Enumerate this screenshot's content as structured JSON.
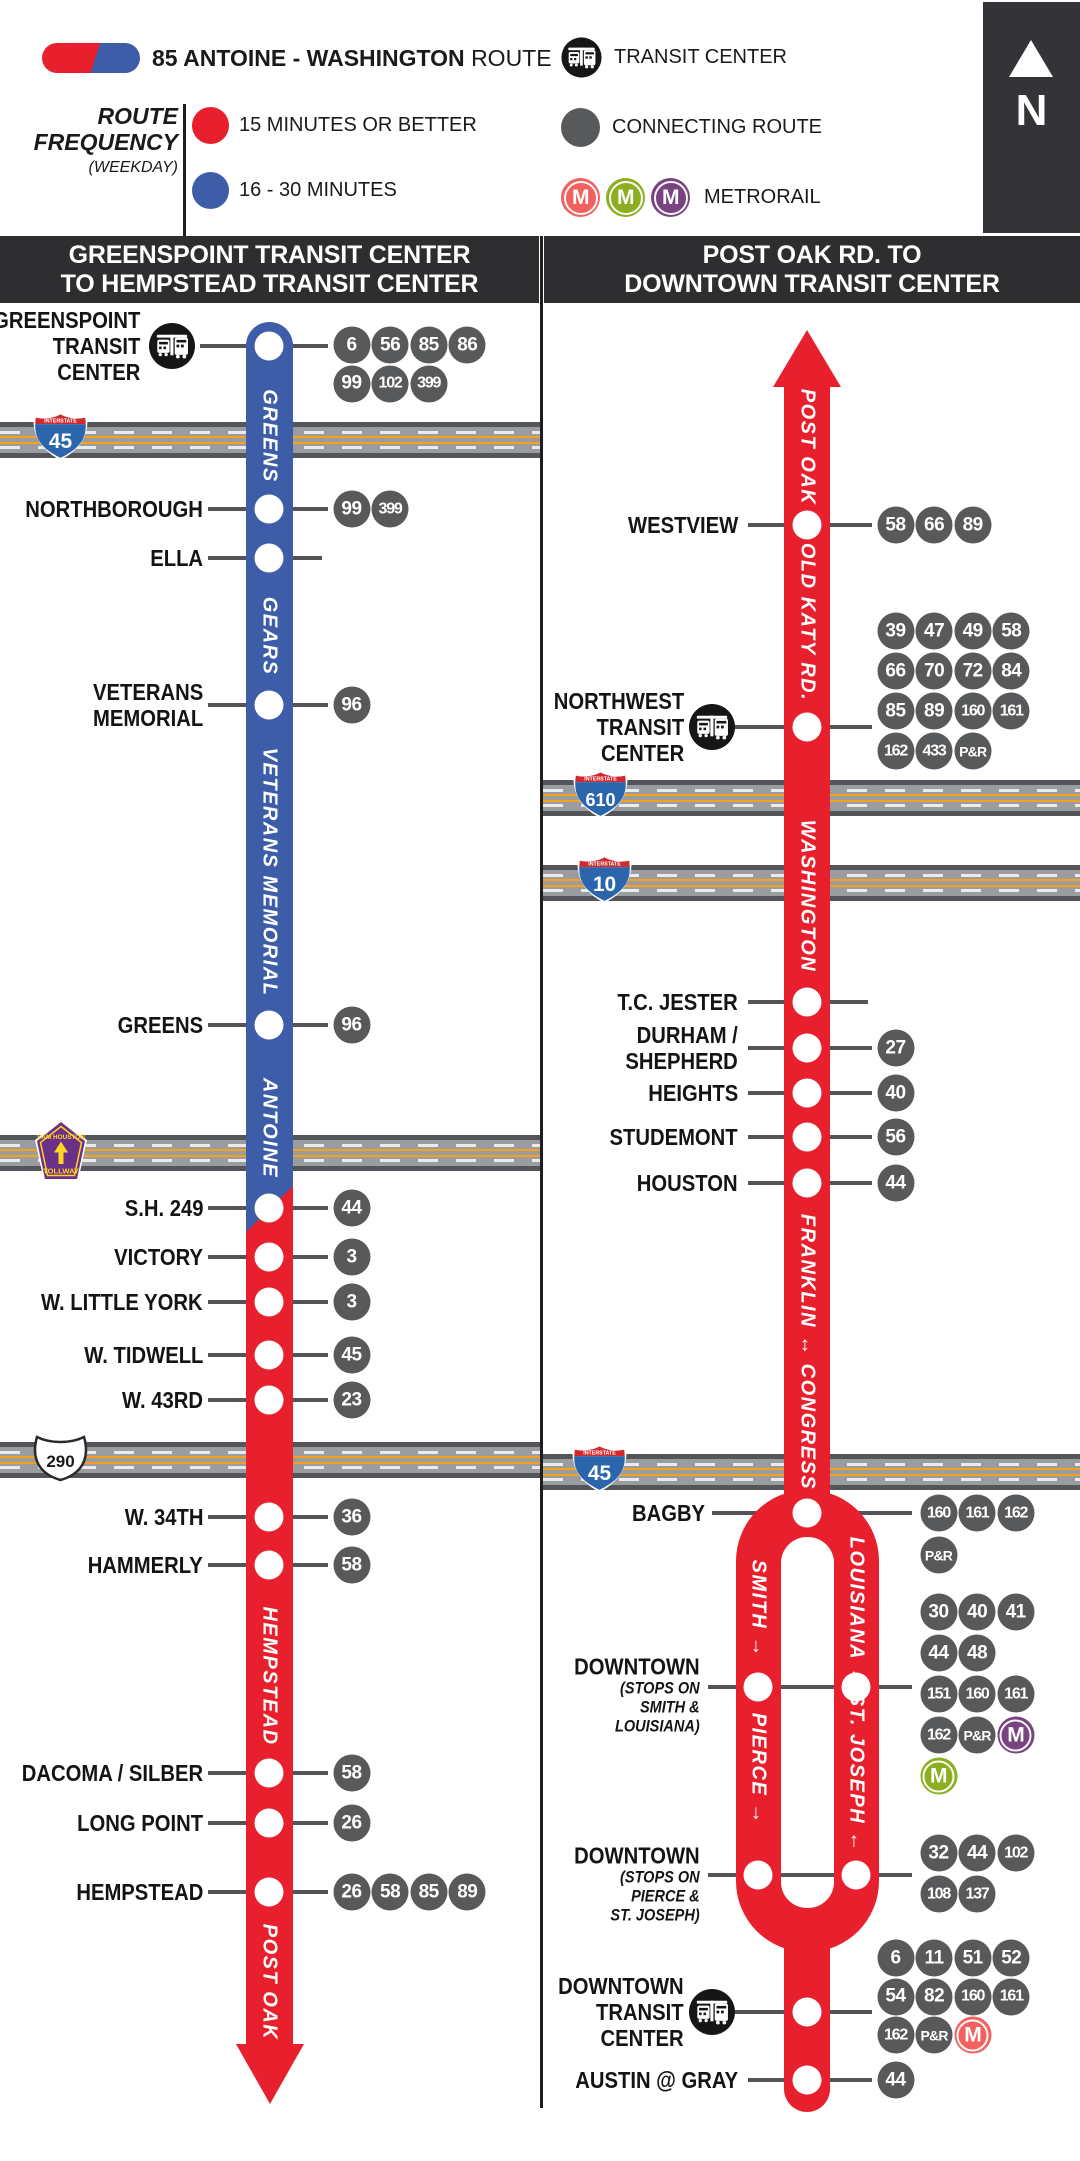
{
  "page": {
    "width": 1080,
    "height": 2161,
    "background": "#FFFFFF"
  },
  "legend": {
    "pill": {
      "left_color": "#E8202E",
      "right_color": "#3D5DA9"
    },
    "route_title_bold": "85 ANTOINE - WASHINGTON",
    "route_title_regular": "ROUTE",
    "frequency": {
      "title_lines": [
        "ROUTE",
        "FREQUENCY"
      ],
      "subtitle": "(WEEKDAY)",
      "items": [
        {
          "color": "#E8202E",
          "label": "15 MINUTES OR BETTER"
        },
        {
          "color": "#3D5DA9",
          "label": "16 - 30 MINUTES"
        }
      ]
    },
    "transit_center_label": "TRANSIT CENTER",
    "connecting_route_label": "CONNECTING ROUTE",
    "connecting_route_color": "#58595B",
    "metrorail_label": "METRORAIL",
    "metrorail_colors": [
      "#F0615F",
      "#8CAF22",
      "#77447F"
    ],
    "north_label": "N"
  },
  "map": {
    "badge_color": "#58595B",
    "tick_color": "#545456",
    "rail_colors": {
      "RED": "#F0615F",
      "GREEN": "#8CAF22",
      "PURPLE": "#77447F"
    },
    "columns": [
      {
        "header_lines": [
          "GREENSPOINT TRANSIT CENTER",
          "TO HEMPSTEAD TRANSIT CENTER"
        ],
        "x": 0,
        "width": 540,
        "line_center_x": 269,
        "line": {
          "type": "two-color",
          "x": 246,
          "width": 47,
          "top": 322,
          "blue_end": 1232,
          "red_start": 1186,
          "shaft_end": 2046,
          "arrow_tip": 2104,
          "blue": "#3D5DA9",
          "red": "#E8202E"
        },
        "highways": [
          {
            "kind": "interstate",
            "number": "45",
            "band_y": 422,
            "shield_x": 32,
            "shield_y": 411
          },
          {
            "kind": "tollway",
            "label_top": "SAM HOUSTON",
            "label_bottom": "TOLLWAY",
            "band_y": 1135,
            "shield_x": 33,
            "shield_y": 1120
          },
          {
            "kind": "us",
            "number": "290",
            "band_y": 1442,
            "shield_x": 33,
            "shield_y": 1434
          }
        ],
        "street_labels": [
          {
            "text": "GREENS",
            "cy": 436
          },
          {
            "text": "GEARS",
            "cy": 636
          },
          {
            "text": "VETERANS MEMORIAL",
            "cy": 872
          },
          {
            "text": "ANTOINE",
            "cy": 1128
          },
          {
            "text": "HEMPSTEAD",
            "cy": 1676
          },
          {
            "text": "POST OAK",
            "cy": 1982
          }
        ],
        "stops": [
          {
            "label": [
              "GREENSPOINT",
              "TRANSIT",
              "CENTER"
            ],
            "y": 346,
            "tc": true,
            "badges": [
              [
                "6",
                "56",
                "85",
                "86"
              ],
              [
                "99",
                "102",
                "399"
              ]
            ],
            "badge_dy": -1
          },
          {
            "label": [
              "NORTHBOROUGH"
            ],
            "y": 509,
            "badges": [
              [
                "99",
                "399"
              ]
            ]
          },
          {
            "label": [
              "ELLA"
            ],
            "y": 558,
            "badges": [],
            "right_tick": true
          },
          {
            "label": [
              "VETERANS",
              "MEMORIAL"
            ],
            "y": 705,
            "badges": [
              [
                "96"
              ]
            ]
          },
          {
            "label": [
              "GREENS"
            ],
            "y": 1025,
            "badges": [
              [
                "96"
              ]
            ]
          },
          {
            "label": [
              "S.H. 249"
            ],
            "y": 1208,
            "badges": [
              [
                "44"
              ]
            ]
          },
          {
            "label": [
              "VICTORY"
            ],
            "y": 1257,
            "badges": [
              [
                "3"
              ]
            ]
          },
          {
            "label": [
              "W. LITTLE YORK"
            ],
            "y": 1302,
            "badges": [
              [
                "3"
              ]
            ]
          },
          {
            "label": [
              "W. TIDWELL"
            ],
            "y": 1355,
            "badges": [
              [
                "45"
              ]
            ]
          },
          {
            "label": [
              "W. 43RD"
            ],
            "y": 1400,
            "badges": [
              [
                "23"
              ]
            ]
          },
          {
            "label": [
              "W. 34TH"
            ],
            "y": 1517,
            "badges": [
              [
                "36"
              ]
            ]
          },
          {
            "label": [
              "HAMMERLY"
            ],
            "y": 1565,
            "badges": [
              [
                "58"
              ]
            ]
          },
          {
            "label": [
              "DACOMA / SILBER"
            ],
            "y": 1773,
            "badges": [
              [
                "58"
              ]
            ]
          },
          {
            "label": [
              "LONG POINT"
            ],
            "y": 1823,
            "badges": [
              [
                "26"
              ]
            ]
          },
          {
            "label": [
              "HEMPSTEAD"
            ],
            "y": 1892,
            "badges": [
              [
                "26",
                "58",
                "85",
                "89"
              ]
            ]
          }
        ]
      },
      {
        "header_lines": [
          "POST OAK RD. TO",
          "DOWNTOWN TRANSIT CENTER"
        ],
        "x": 540,
        "width": 540,
        "line_center_x": 807,
        "line": {
          "type": "loop",
          "x": 784,
          "width": 46,
          "arrow_tip": 330,
          "arrow_base": 387,
          "shaft_end": 1530,
          "color": "#E8202E",
          "loop": {
            "outer_x": 736,
            "outer_top": 1490,
            "outer_w": 143,
            "outer_bottom": 1952,
            "leg_w": 45,
            "hole_top": 1537,
            "hole_bottom": 1908,
            "left_leg_cx": 758,
            "right_leg_cx": 856
          },
          "stem_bottom": 2112
        },
        "highways": [
          {
            "kind": "interstate",
            "number": "610",
            "band_y": 780,
            "shield_x": 572,
            "shield_y": 769
          },
          {
            "kind": "interstate",
            "number": "10",
            "band_y": 865,
            "shield_x": 576,
            "shield_y": 854
          },
          {
            "kind": "interstate",
            "number": "45",
            "band_y": 1454,
            "shield_x": 571,
            "shield_y": 1443
          }
        ],
        "street_labels": [
          {
            "text": "POST OAK",
            "cy": 447
          },
          {
            "text": "OLD KATY RD.",
            "cy": 622
          },
          {
            "text": "WASHINGTON",
            "cy": 896
          },
          {
            "text": "FRANKLIN ↔ CONGRESS",
            "cy": 1352
          },
          {
            "text": "SMITH",
            "arrow": "down",
            "cy": 1608,
            "cx": 758
          },
          {
            "text": "LOUISIANA",
            "arrow": "up",
            "cy": 1612,
            "cx": 856
          },
          {
            "text": "PIERCE",
            "arrow": "down",
            "cy": 1768,
            "cx": 758
          },
          {
            "text": "ST. JOSEPH",
            "arrow": "up",
            "cy": 1772,
            "cx": 856
          }
        ],
        "stops": [
          {
            "label": [
              "WESTVIEW"
            ],
            "y": 525,
            "badges": [
              [
                "58",
                "66",
                "89"
              ]
            ]
          },
          {
            "label": [
              "NORTHWEST",
              "TRANSIT",
              "CENTER"
            ],
            "y": 727,
            "tc": true,
            "badges": [
              [
                "39",
                "47",
                "49",
                "58"
              ],
              [
                "66",
                "70",
                "72",
                "84"
              ],
              [
                "85",
                "89",
                "160",
                "161"
              ],
              [
                "162",
                "433",
                "P&R"
              ]
            ],
            "badge_dy": -96,
            "badge_row_gap": 40
          },
          {
            "label": [
              "T.C. JESTER"
            ],
            "y": 1002,
            "badges": [],
            "right_tick": true
          },
          {
            "label": [
              "DURHAM /",
              "SHEPHERD"
            ],
            "y": 1048,
            "badges": [
              [
                "27"
              ]
            ]
          },
          {
            "label": [
              "HEIGHTS"
            ],
            "y": 1093,
            "badges": [
              [
                "40"
              ]
            ]
          },
          {
            "label": [
              "STUDEMONT"
            ],
            "y": 1137,
            "badges": [
              [
                "56"
              ]
            ]
          },
          {
            "label": [
              "HOUSTON"
            ],
            "y": 1183,
            "badges": [
              [
                "44"
              ]
            ]
          },
          {
            "label": [
              "BAGBY"
            ],
            "y": 1513,
            "on_loop_top": true,
            "label_edge": 705,
            "badges": [
              [
                "160",
                "161",
                "162"
              ],
              [
                "P&R"
              ]
            ],
            "badge_start_x": 920,
            "badge_row_gap": 42
          },
          {
            "label": [
              "DOWNTOWN"
            ],
            "sub": [
              "(STOPS ON",
              "SMITH &",
              "LOUISIANA)"
            ],
            "y": 1687,
            "loop_pair": true,
            "badges": [
              [
                "30",
                "40",
                "41"
              ],
              [
                "44",
                "48"
              ],
              [
                "151",
                "160",
                "161"
              ],
              [
                "162",
                "P&R",
                "M-PURPLE"
              ],
              [
                "M-GREEN"
              ]
            ],
            "badge_start_x": 920,
            "badge_dy": -75,
            "badge_row_gap": 41,
            "label_dy": 8
          },
          {
            "label": [
              "DOWNTOWN"
            ],
            "sub": [
              "(STOPS ON",
              "PIERCE &",
              "ST. JOSEPH)"
            ],
            "y": 1875,
            "loop_pair": true,
            "badges": [
              [
                "32",
                "44",
                "102"
              ],
              [
                "108",
                "137"
              ]
            ],
            "badge_start_x": 920,
            "badge_dy": -22,
            "badge_row_gap": 41,
            "label_dy": 9
          },
          {
            "label": [
              "DOWNTOWN",
              "TRANSIT",
              "CENTER"
            ],
            "y": 2012,
            "tc": true,
            "badges": [
              [
                "6",
                "11",
                "51",
                "52"
              ],
              [
                "54",
                "82",
                "160",
                "161"
              ],
              [
                "162",
                "P&R",
                "M-RED"
              ]
            ],
            "badge_dy": -54,
            "badge_row_gap": 38.5
          },
          {
            "label": [
              "AUSTIN @ GRAY"
            ],
            "y": 2080,
            "badges": [
              [
                "44"
              ]
            ]
          }
        ]
      }
    ]
  }
}
